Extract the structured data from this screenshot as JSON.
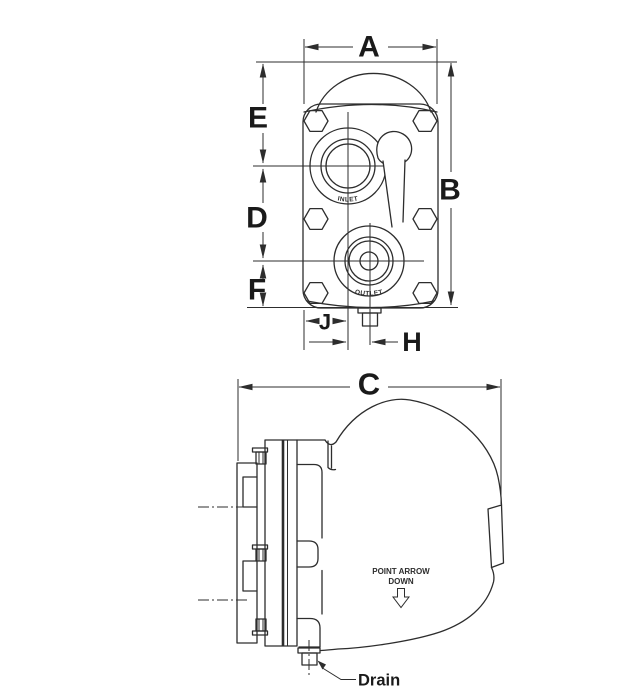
{
  "drawing": {
    "type": "technical-dimension-drawing",
    "dims": {
      "a": "A",
      "b": "B",
      "c": "C",
      "d": "D",
      "e": "E",
      "f": "F",
      "h": "H",
      "j": "J"
    },
    "annotations": {
      "inlet": "INLET",
      "outlet": "OUTLET",
      "point_arrow_line1": "POINT ARROW",
      "point_arrow_line2": "DOWN",
      "drain": "Drain"
    },
    "views": [
      {
        "name": "front-view",
        "dimension_labels": [
          "A",
          "B",
          "D",
          "E",
          "F",
          "H",
          "J"
        ]
      },
      {
        "name": "side-view",
        "dimension_labels": [
          "C"
        ]
      }
    ],
    "colors": {
      "line": "#2d2d2d",
      "text": "#1a1a1a",
      "background": "#ffffff"
    }
  }
}
